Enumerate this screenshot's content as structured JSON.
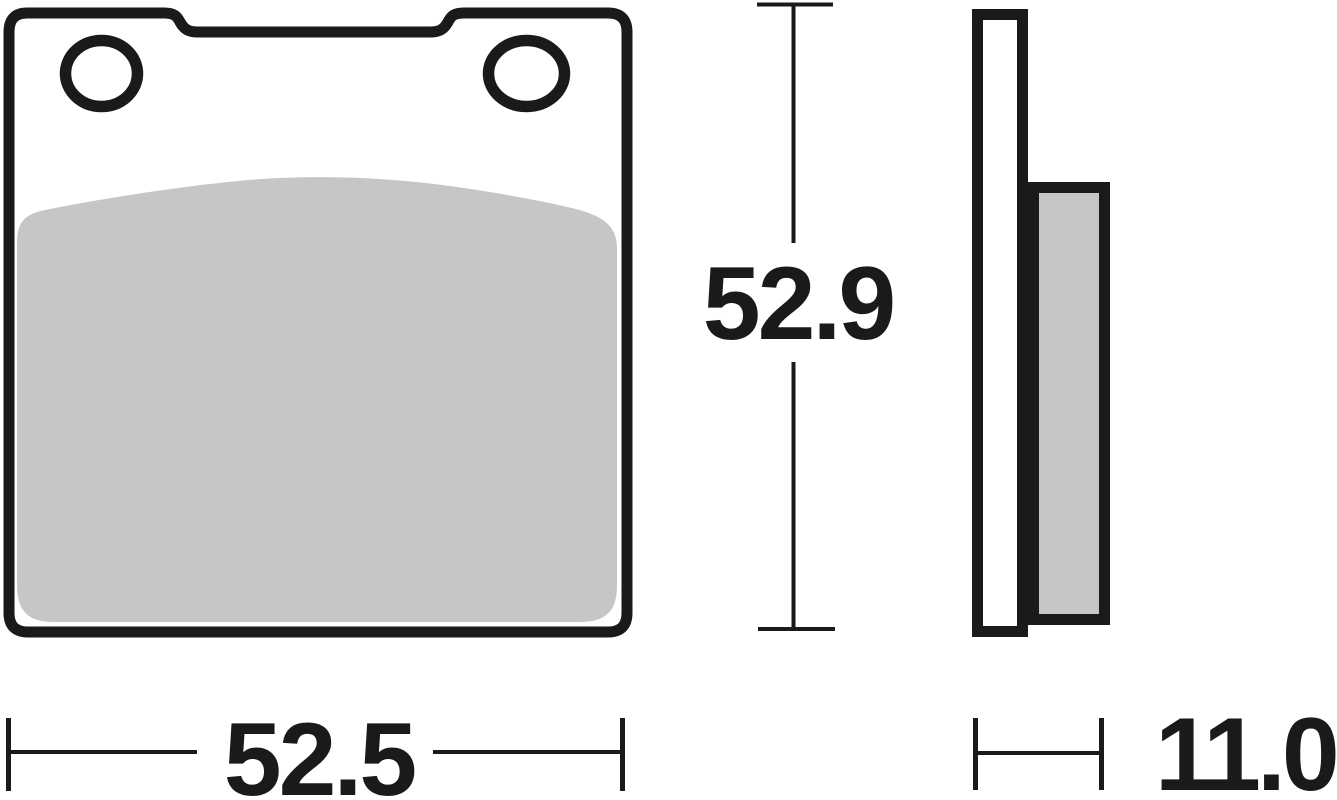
{
  "drawing": {
    "labels": {
      "height": "52.9",
      "width": "52.5",
      "thickness": "11.0"
    },
    "colors": {
      "line": "#1a1a1a",
      "plate_fill": "#ffffff",
      "friction_material": "#c6c6c6",
      "background": "#ffffff"
    }
  }
}
